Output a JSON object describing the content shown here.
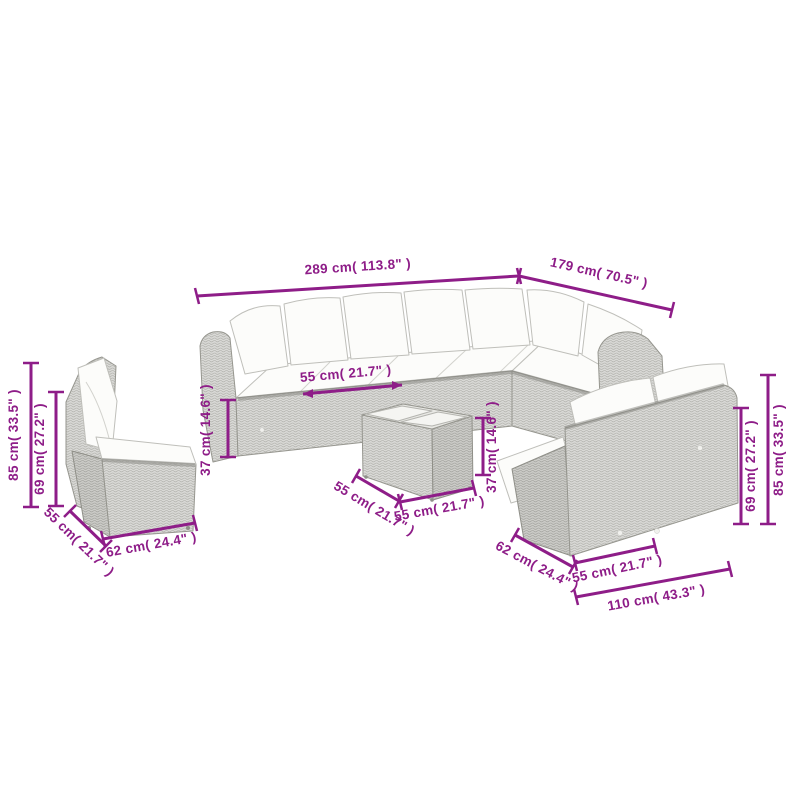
{
  "figure": {
    "kind": "product-dimension-diagram",
    "pieces": [
      "single-chair",
      "corner-sofa",
      "coffee-table",
      "two-seater-bench"
    ]
  },
  "colors": {
    "dimension": "#8e1d88",
    "wicker_light": "#dadad7",
    "wicker_shadow": "#ccccc8",
    "outline": "#96968f",
    "cushion": "#fcfcfa",
    "background": "#ffffff"
  },
  "dimensions": [
    {
      "id": "sofa-total-width",
      "text": "289 cm( 113.8\" )"
    },
    {
      "id": "sofa-total-depth",
      "text": "179 cm( 70.5\" )"
    },
    {
      "id": "chair-total-height",
      "text": "85 cm( 33.5\" )"
    },
    {
      "id": "chair-back-height",
      "text": "69 cm( 27.2\" )"
    },
    {
      "id": "chair-depth",
      "text": "55 cm( 21.7\" )"
    },
    {
      "id": "chair-width",
      "text": "62 cm( 24.4\" )"
    },
    {
      "id": "seat-width",
      "text": "55 cm( 21.7\" )"
    },
    {
      "id": "seat-height",
      "text": "37 cm( 14.6\" )"
    },
    {
      "id": "table-depth",
      "text": "55 cm( 21.7\" )"
    },
    {
      "id": "table-width",
      "text": "55 cm( 21.7\" )"
    },
    {
      "id": "table-height",
      "text": "37 cm( 14.6\" )"
    },
    {
      "id": "bench-depth",
      "text": "62 cm( 24.4\" )"
    },
    {
      "id": "bench-seat-width",
      "text": "55 cm( 21.7\" )"
    },
    {
      "id": "bench-total-width",
      "text": "110 cm( 43.3\" )"
    },
    {
      "id": "bench-back-height",
      "text": "69 cm( 27.2\" )"
    },
    {
      "id": "bench-total-height",
      "text": "85 cm( 33.5\" )"
    }
  ]
}
